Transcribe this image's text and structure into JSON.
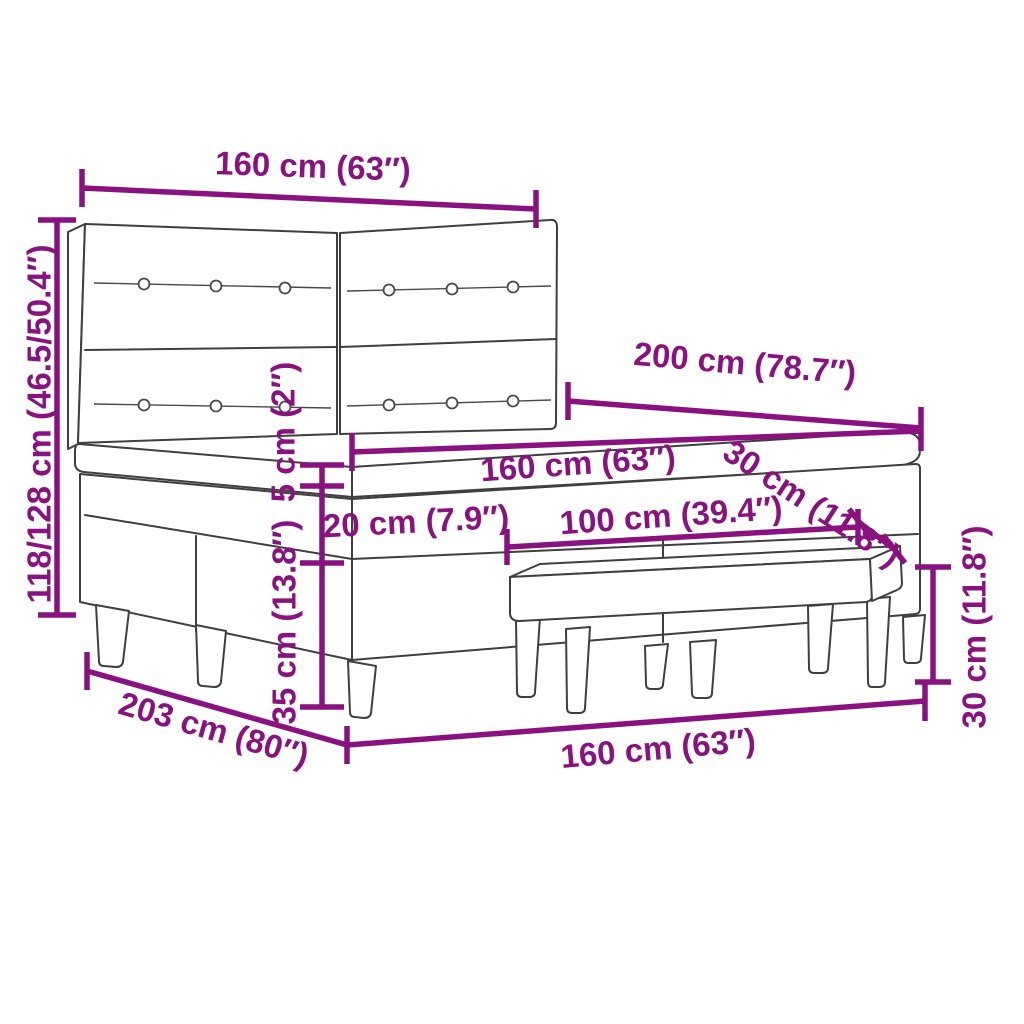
{
  "diagram": {
    "type": "furniture-dimension-diagram",
    "subject": "box spring bed with tufted headboard, mattress and bench",
    "colors": {
      "dimension_accent": "#8A1280",
      "line_art": "#3F3F3F",
      "background": "#FFFFFF"
    },
    "dimensions": [
      {
        "id": "headboard-width",
        "label": "160 cm (63″)"
      },
      {
        "id": "total-height",
        "label": "118/128 cm (46.5/50.4″)"
      },
      {
        "id": "bed-length",
        "label": "200 cm (78.7″)"
      },
      {
        "id": "mattress-width",
        "label": "160 cm (63″)"
      },
      {
        "id": "mattress-depth",
        "label": "30 cm (11.8″)"
      },
      {
        "id": "bench-length",
        "label": "100 cm (39.4″)"
      },
      {
        "id": "mattress-height",
        "label": "5 cm (2″)"
      },
      {
        "id": "box-height",
        "label": "20 cm (7.9″)"
      },
      {
        "id": "leg-height",
        "label": "35 cm (13.8″)"
      },
      {
        "id": "frame-length",
        "label": "203 cm (80″)"
      },
      {
        "id": "frame-width",
        "label": "160 cm (63″)"
      },
      {
        "id": "bench-height",
        "label": "30 cm (11.8″)"
      }
    ]
  }
}
